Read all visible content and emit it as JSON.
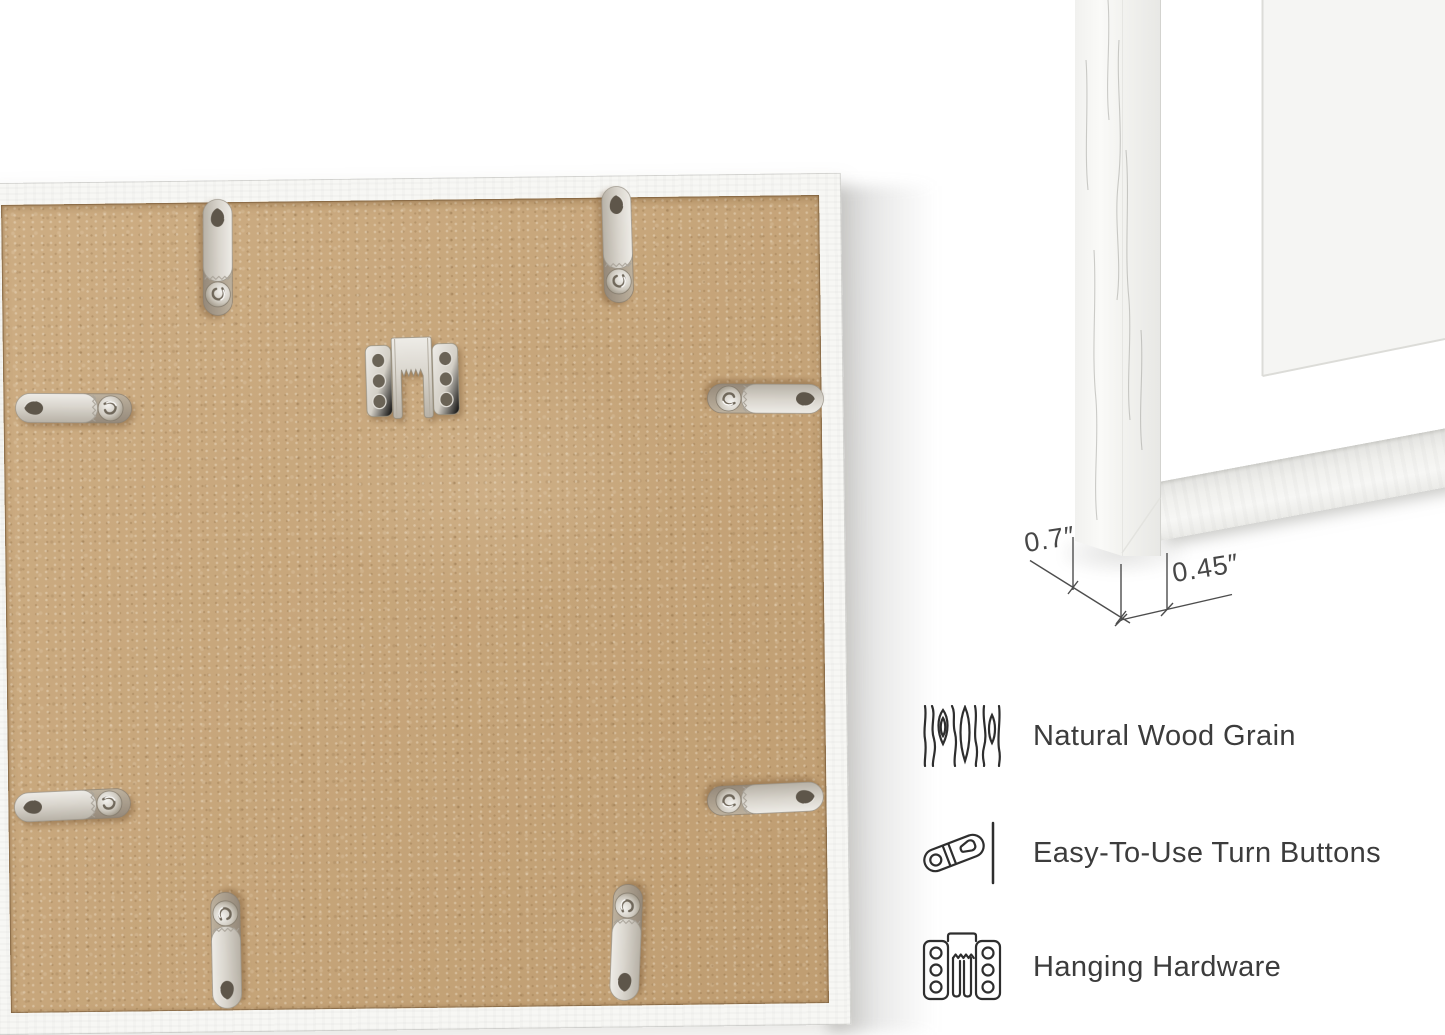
{
  "page": {
    "background": "#ffffff",
    "description": "picture frame product photos"
  },
  "colors": {
    "mdf_board": "#c8a77c",
    "frame_white": "#f7f7f4",
    "metal_light": "#ece9e4",
    "metal_dark": "#9c9180",
    "line_art": "#2e2e2e",
    "dimension_line": "#4d4d4d",
    "caption_text": "#3c3c3c"
  },
  "main_photo": {
    "subject": "frame-back-with-hardware",
    "hardware": {
      "sawtooth_hanger_count": 1,
      "turn_button_count": 8
    }
  },
  "corner_photo": {
    "subject": "white-frame-corner-with-mat"
  },
  "dimensions": {
    "depth_label": "0.7″",
    "face_label": "0.45″"
  },
  "features": [
    {
      "icon": "wood-grain-icon",
      "label": "Natural Wood Grain"
    },
    {
      "icon": "turn-button-icon",
      "label": "Easy-To-Use Turn Buttons"
    },
    {
      "icon": "hanging-hardware-icon",
      "label": "Hanging Hardware"
    }
  ]
}
